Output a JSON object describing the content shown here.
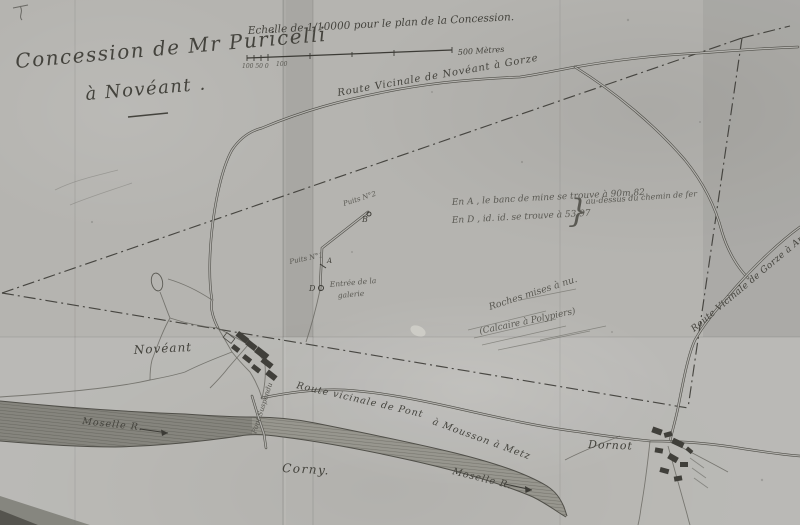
{
  "colors": {
    "paper": "#b5b4b0",
    "ink": "#44433d",
    "ink_faint": "#5a5953",
    "river_fill": "#98978f",
    "boundary": "#34332e"
  },
  "title": {
    "line1": "Concession de Mr Puricelli",
    "line2": "à Novéant ."
  },
  "scale": {
    "caption": "Echelle de 1/10000 pour le plan de la Concession.",
    "ticks_left": "100  50  0",
    "tick_mid": "100",
    "right_label": "500 Mètres"
  },
  "roads": {
    "noveant_gorze": "Route Vicinale de Novéant à Gorze",
    "gorze_ancy": "Route Vicinale de Gorze à Ancy",
    "pm_metz_part1": "Route vicinale de Pont",
    "pm_metz_part2": "à Mousson  à  Metz"
  },
  "places": {
    "noveant": "Novéant",
    "corny": "Corny.",
    "dornot": "Dornot",
    "bridge": "Pont Suspendu"
  },
  "river": {
    "label_left": "Moselle R.",
    "label_right": "Moselle R."
  },
  "mine": {
    "puits2": "Puits N°2",
    "puits2_point": "B",
    "puits1": "Puits N°1",
    "puits1_point": "A",
    "gallery_point": "D",
    "gallery_line1": "Entrée de la",
    "gallery_line2": "galerie"
  },
  "note": {
    "line1": "En A , le banc de mine se trouve à 90m,82",
    "line2": "En D ,    id.      id.    se trouve à 53,97",
    "brace": "}",
    "side": "au-dessus du chemin de fer"
  },
  "geology": {
    "line1": "Roches mises à nu.",
    "line2": "(Calcaire à Polypiers)"
  }
}
